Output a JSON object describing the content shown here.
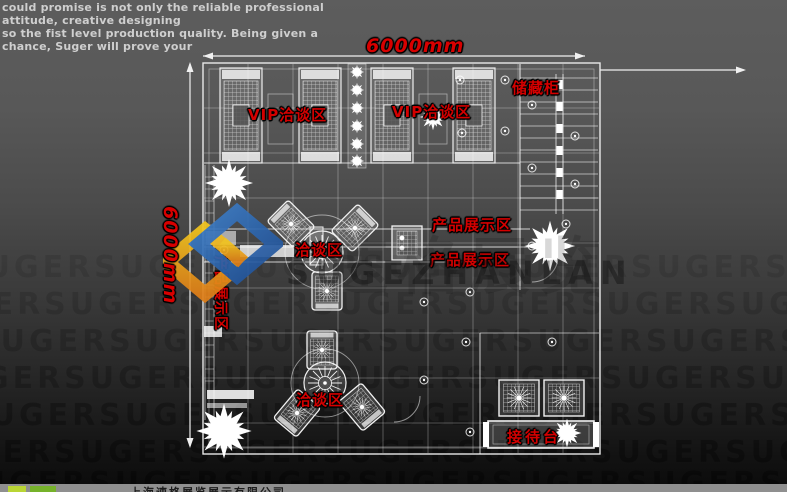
{
  "header": {
    "line1": "could promise is not only the reliable professional attitude, creative designing",
    "line2": "so the fist level production quality. Being given a chance, Suger will prove your"
  },
  "dimensions": {
    "width_label": "6000mm",
    "height_label": "6000mm"
  },
  "plan_labels": {
    "vip_area_left": "VIP洽谈区",
    "vip_area_right": "VIP洽谈区",
    "storage_cabinet": "储藏柜",
    "product_display_right_upper": "产品展示区",
    "product_display_right_lower": "产品展示区",
    "product_display_left": "产品展示区",
    "meeting_area_center": "洽谈区",
    "meeting_area_bottom": "洽谈区",
    "reception_desk": "接待台"
  },
  "watermark": {
    "brand": "SUGEZHANLAN",
    "brand_cn": "速格展览",
    "pattern_row": "SUGERSUGERSUGERSUGERSUGERSUGERSUGERSUGERSUGERSUGER"
  },
  "footer": {
    "company": "上海速格展览展示有限公司"
  },
  "colors": {
    "label_red": "#d40000",
    "line_white": "#f0f0f0",
    "logo_blue": "#2e6db4",
    "logo_yellow": "#f2c41d",
    "logo_orange": "#e07f18",
    "footer_green": "#76b22a"
  }
}
